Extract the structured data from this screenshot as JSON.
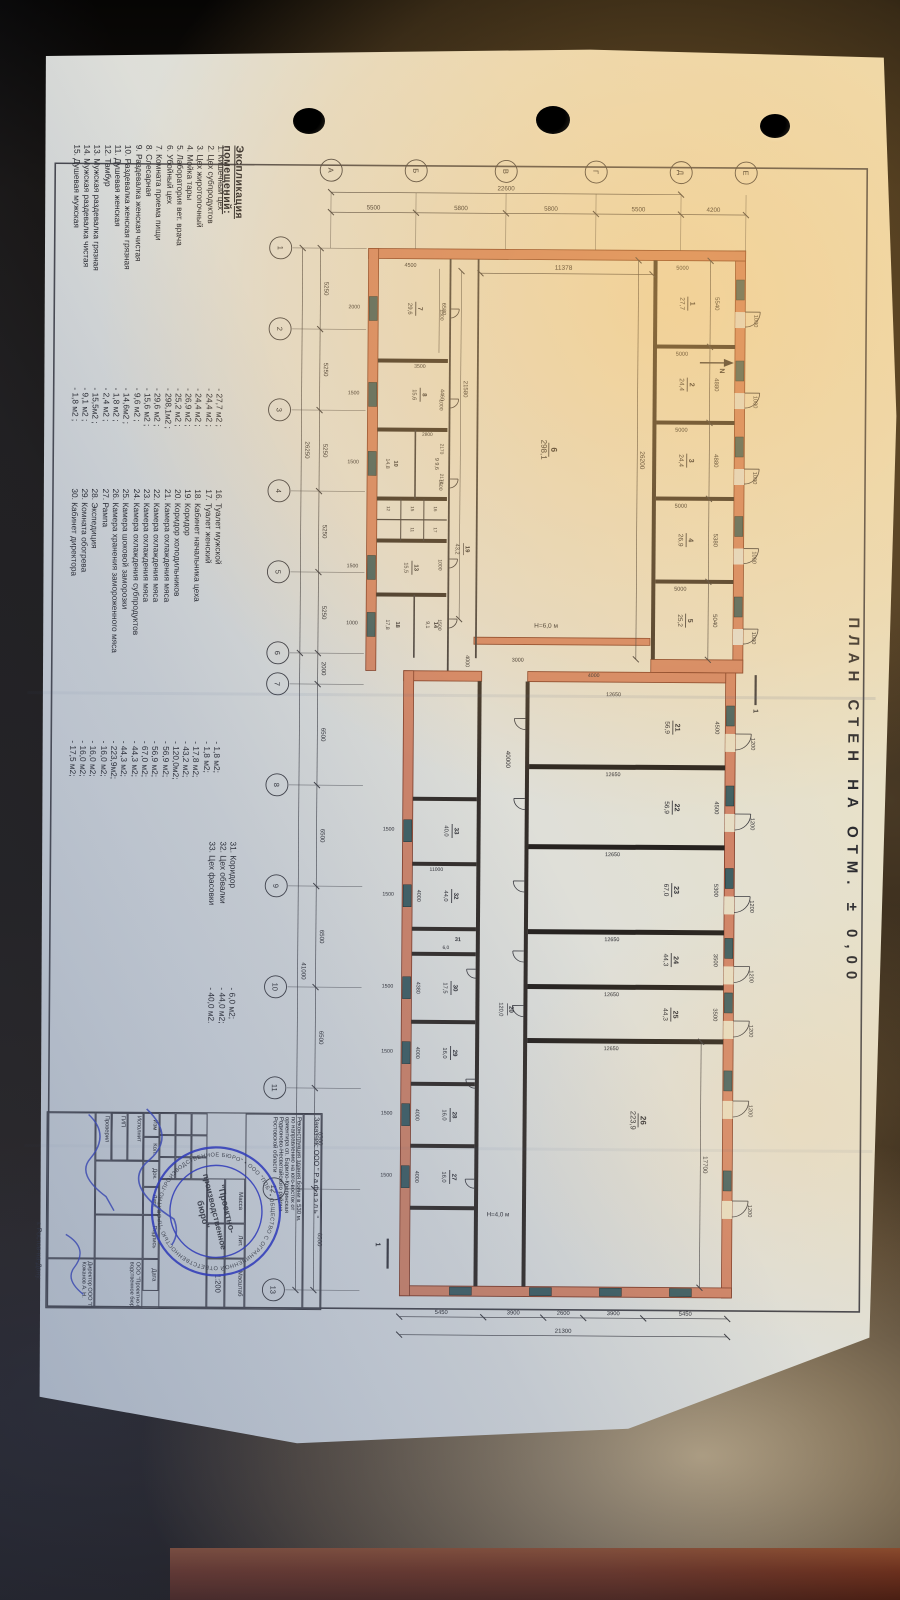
{
  "main_title": "ПЛАН  СТЕН  НА  ОТМ. ± 0,00",
  "explication": {
    "title": "Экспликация помещений:",
    "items": [
      {
        "n": "1.",
        "name": "Кишечный цех",
        "val": "- 27,7 м2 ;"
      },
      {
        "n": "2.",
        "name": "Цех субпродуктов",
        "val": "- 24,4 м2 ;"
      },
      {
        "n": "3.",
        "name": "Цех жиротопочный",
        "val": "- 24,4 м2 ;"
      },
      {
        "n": "4.",
        "name": "Мойка тары",
        "val": "- 26,9 м2 ;"
      },
      {
        "n": "5.",
        "name": "Лаборатория вет. врача",
        "val": "- 25,2 м2 ;"
      },
      {
        "n": "6.",
        "name": "Убойный цех",
        "val": "- 298,1м2 ;"
      },
      {
        "n": "7.",
        "name": "Комната приема пищи",
        "val": "- 29,6 м2 ;"
      },
      {
        "n": "8.",
        "name": "Слесарная",
        "val": "- 15,6 м2 ;"
      },
      {
        "n": "9.",
        "name": "Раздевалка женская чистая",
        "val": "- 9,6 м2 ;"
      },
      {
        "n": "10.",
        "name": "Раздевалка женская грязная",
        "val": "- 14,6м2 ;"
      },
      {
        "n": "11.",
        "name": "Душевая женская",
        "val": "- 1,8 м2 ;"
      },
      {
        "n": "12.",
        "name": "Тамбур",
        "val": "- 2,4 м2 ;"
      },
      {
        "n": "13.",
        "name": "Мужская раздевалка грязная",
        "val": "- 15,5м2 ;"
      },
      {
        "n": "14.",
        "name": "Мужская раздевалка чистая",
        "val": "- 9,1 м2 ;"
      },
      {
        "n": "15.",
        "name": "Душевая мужская",
        "val": "- 1,8 м2 ;"
      },
      {
        "n": "16.",
        "name": "Туалет мужской",
        "val": "- 1,8 м2;"
      },
      {
        "n": "17.",
        "name": "Туалет женский",
        "val": "- 1,8 м2;"
      },
      {
        "n": "18.",
        "name": "Кабинет начальника цеха",
        "val": "- 17,8 м2;"
      },
      {
        "n": "19.",
        "name": "Коридор",
        "val": "- 43,2 м2;"
      },
      {
        "n": "20.",
        "name": "Коридор холодильников",
        "val": "- 120,0м2;"
      },
      {
        "n": "21.",
        "name": "Камера охлаждения мяса",
        "val": "- 56,9 м2;"
      },
      {
        "n": "22.",
        "name": "Камера охлаждения мяса",
        "val": "- 56,9 м2;"
      },
      {
        "n": "23.",
        "name": "Камера охлаждения мяса",
        "val": "- 67,0 м2;"
      },
      {
        "n": "24.",
        "name": "Камера охлаждения субпродуктов",
        "val": "- 44,3 м2;"
      },
      {
        "n": "25.",
        "name": "Камера шоковой заморозки",
        "val": "- 44,3 м2;"
      },
      {
        "n": "26.",
        "name": "Камера хранения замороженного мяса",
        "val": "- 223,9м2;"
      },
      {
        "n": "27.",
        "name": "Рампа",
        "val": "- 16,0 м2;"
      },
      {
        "n": "28.",
        "name": "Экспедиция",
        "val": "- 16,0 м2;"
      },
      {
        "n": "29.",
        "name": "Комната обогрева",
        "val": "- 16,0 м2;"
      },
      {
        "n": "30.",
        "name": "Кабинет директора",
        "val": "- 17,5 м2;"
      },
      {
        "n": "31.",
        "name": "Коридор",
        "val": "- 6,0 м2;"
      },
      {
        "n": "32.",
        "name": "Цех обвалки",
        "val": "- 44,0 м2;"
      },
      {
        "n": "33.",
        "name": "Цех фасовки",
        "val": "- 40,0 м2."
      }
    ]
  },
  "plan": {
    "axes_numbers": [
      "1",
      "2",
      "3",
      "4",
      "5",
      "6",
      "7",
      "8",
      "9",
      "10",
      "11",
      "12",
      "13"
    ],
    "axes_letters": [
      "А",
      "Б",
      "В",
      "Г",
      "Д",
      "Е"
    ],
    "bottom_segments": [
      "5250",
      "5250",
      "5250",
      "5250",
      "5250",
      "2000",
      "6500",
      "6500",
      "6500",
      "6500",
      "6500",
      "6500"
    ],
    "bottom_totals": [
      "26250",
      "41000"
    ],
    "left_segments": [
      "5500",
      "5800",
      "5800",
      "5500",
      "4200"
    ],
    "left_total": "22600",
    "right_segments": [
      "5450",
      "3900",
      "2600",
      "3900",
      "5450"
    ],
    "right_total": "21300",
    "rooms_top": [
      {
        "n": "1",
        "a": "27,7"
      },
      {
        "n": "2",
        "a": "24,4"
      },
      {
        "n": "3",
        "a": "24,4"
      },
      {
        "n": "4",
        "a": "26,9"
      },
      {
        "n": "5",
        "a": "25,2"
      }
    ],
    "top_widths": [
      "5540",
      "4880",
      "4880",
      "5380",
      "5040"
    ],
    "top_depth": "5000",
    "top_door": "1000",
    "hall": {
      "n": "6",
      "a": "298,1",
      "len": "26200",
      "dep": "11378",
      "h": "Н=6,0 м"
    },
    "corr19": {
      "n": "19",
      "a": "43,2",
      "len": "21580"
    },
    "band_rooms": [
      {
        "n": "7",
        "a": "29,6",
        "d": "6580"
      },
      {
        "n": "8",
        "a": "15,6",
        "d": "4460"
      },
      {
        "n": "9",
        "a": "9,6",
        "d": ""
      },
      {
        "n": "10",
        "a": "14,8",
        "d": ""
      },
      {
        "n": "13",
        "a": "15,5",
        "d": ""
      },
      {
        "n": "14",
        "a": "9,1",
        "d": ""
      },
      {
        "n": "18",
        "a": "17,8",
        "d": "4460"
      }
    ],
    "band_small": [
      "16",
      "17",
      "15",
      "11",
      "12"
    ],
    "band_dims": {
      "r7side": "4500",
      "r8side": "3500",
      "p2170": "2170",
      "p2800": "2800"
    },
    "bottom_wall_doors": [
      "2000",
      "1500",
      "1500",
      "1500",
      "1000"
    ],
    "corr19_doors": [
      "1500",
      "1000",
      "1500",
      "1000",
      "1500"
    ],
    "wing_rooms": [
      {
        "n": "21",
        "a": "56,9",
        "w": "4500"
      },
      {
        "n": "22",
        "a": "56,9",
        "w": "4500"
      },
      {
        "n": "23",
        "a": "67,0",
        "w": "5300"
      },
      {
        "n": "24",
        "a": "44,3",
        "w": "3500"
      },
      {
        "n": "25",
        "a": "44,3",
        "w": "3500"
      }
    ],
    "room26": {
      "n": "26",
      "a": "223,9",
      "w": "17700",
      "h": "Н=4,0 м"
    },
    "wing_depth": "12650",
    "wing_door": "1200",
    "corr20": {
      "n": "20",
      "a": "120,0",
      "len": "40000",
      "jog": "3000",
      "jog2": "4000"
    },
    "wing_band": [
      {
        "n": "33",
        "a": "40,0",
        "w": ""
      },
      {
        "n": "32",
        "a": "44,0",
        "w": "4000"
      },
      {
        "n": "31",
        "a": "6,0",
        "w": ""
      },
      {
        "n": "30",
        "a": "17,5",
        "w": "4380"
      },
      {
        "n": "29",
        "a": "16,0",
        "w": "4000"
      },
      {
        "n": "28",
        "a": "16,0",
        "w": "4000"
      },
      {
        "n": "27",
        "a": "16,0",
        "w": "4000"
      }
    ],
    "wing_band_depth": "11000",
    "wing_band_doors": [
      "1500",
      "1500",
      "1500",
      "1500",
      "1500",
      "1500"
    ],
    "north": "N",
    "section": "1"
  },
  "title_block": {
    "customer": "Заказчик: ООО \" Р а ф а э л ь \"",
    "project": [
      "Реконструкция  здания бойни в 530 м.",
      "по направлению на юго-восток от",
      "ориентира  сп. Барило-Крепинская",
      "Родионово-Несветайского района",
      "Ростовской области"
    ],
    "mass": "Масса",
    "lit": "Лит.",
    "scale_label": "Масштаб",
    "scale": "1:200",
    "cols": [
      "Изм",
      "Кол.",
      "Док.",
      "Лист",
      "Подпись",
      "Дата"
    ],
    "rows": [
      "Исполнит",
      "ГИП",
      "Проверил"
    ],
    "org1": "ООО \"Проектно-произ-",
    "org2": "водственное бюро\"",
    "director": "Директор ООО \"ППБ\"",
    "director_name": "Кожанов А. Н.",
    "city": "г. Ростов-на-Дону."
  },
  "stamp": {
    "ring": "ОБЩЕСТВО С ОГРАНИЧЕННОЙ ОТВЕТСТВЕННОСТЬЮ \"ПРОЕКТНО-ПРОИЗВОДСТВЕННОЕ БЮРО\" • ООО \"ППБ\" • ОГРН 1086164004456 • ИНН 6164278346 • г. РОСТОВ-НА-ДОНУ •",
    "c1": "\"Проектно-",
    "c2": "производственное",
    "c3": "бюро\""
  },
  "colors": {
    "wall": "#d08468",
    "wall_stroke": "#7e3a26",
    "dark_wall": "#332d29",
    "window": "#3f5f63",
    "ink": "#2e2e33",
    "stamp": "#2b35c8",
    "pen": "#3a47c0"
  }
}
